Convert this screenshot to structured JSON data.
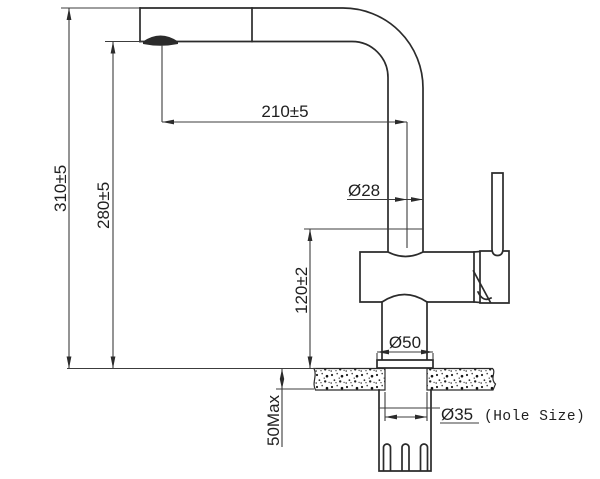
{
  "drawing": {
    "subject": "pull-out kitchen faucet installation dimension drawing",
    "labels": {
      "total_height": "310±5",
      "aerator_height": "280±5",
      "spout_reach": "210±5",
      "spout_tube_diameter": "Ø28",
      "body_height": "120±2",
      "base_diameter": "Ø50",
      "hole_diameter": "Ø35",
      "hole_size_note": "(Hole Size)",
      "max_counter_thickness": "50Max"
    }
  }
}
